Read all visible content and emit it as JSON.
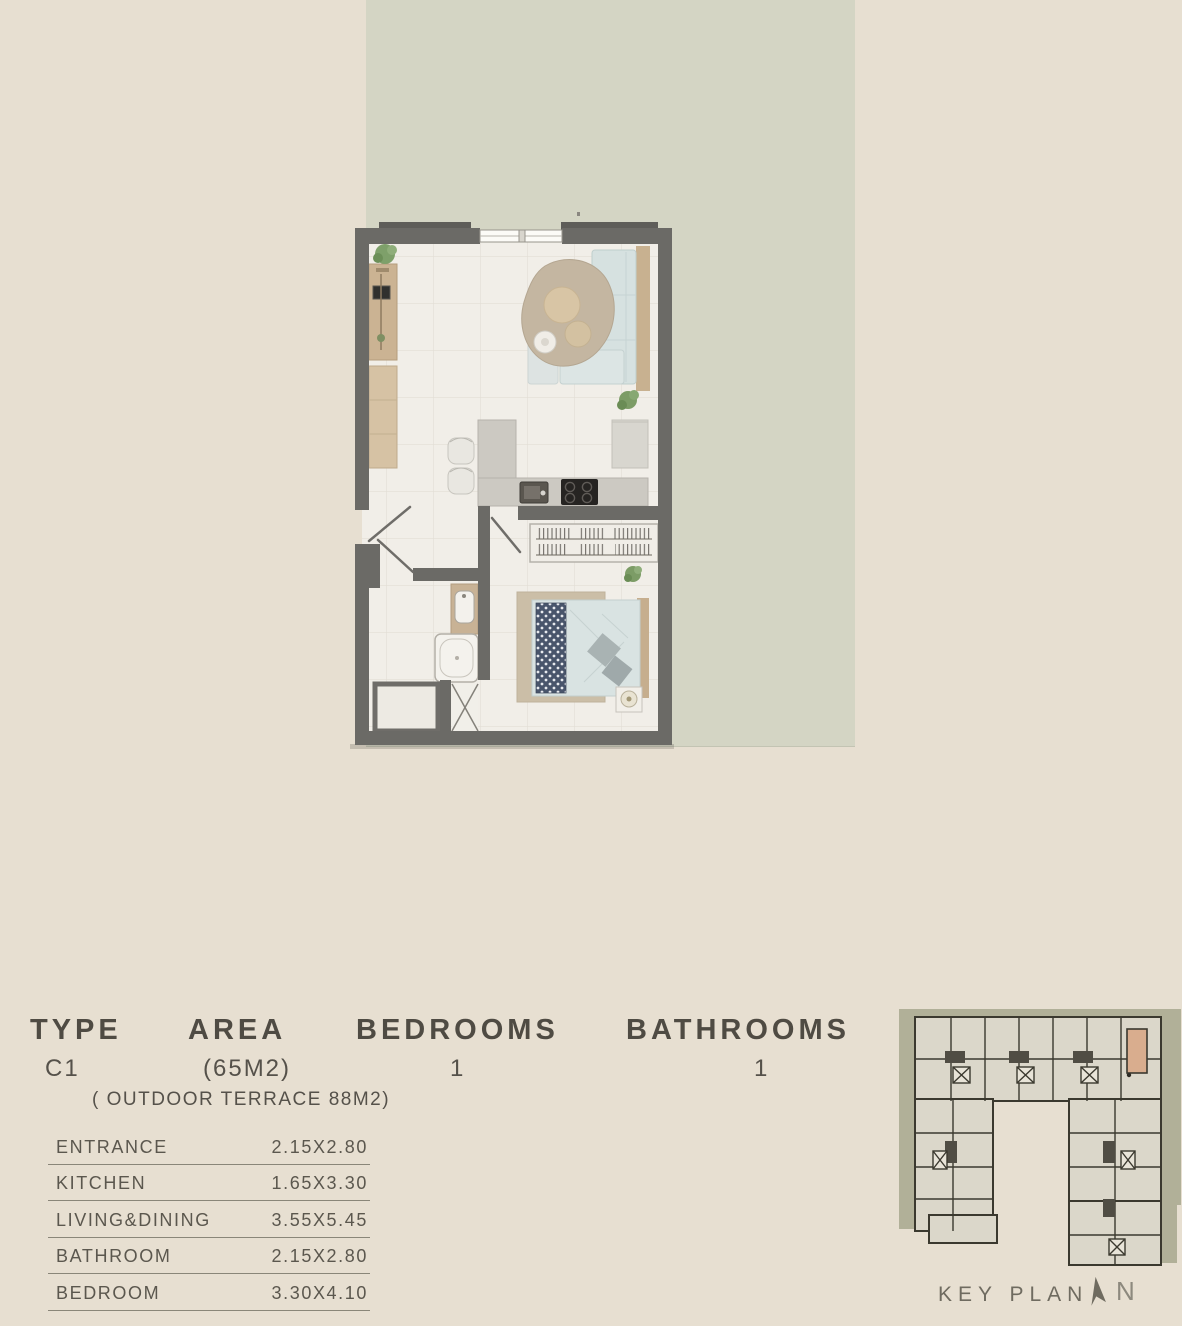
{
  "unit_table": {
    "headers": {
      "type": "TYPE",
      "area": "AREA",
      "bedrooms": "BEDROOMS",
      "bathrooms": "BATHROOMS"
    },
    "values": {
      "type": "C1",
      "area": "(65M2)",
      "bedrooms": "1",
      "bathrooms": "1"
    },
    "area_note": "( OUTDOOR TERRACE 88M2)"
  },
  "room_dimensions": [
    {
      "room": "ENTRANCE",
      "size": "2.15X2.80"
    },
    {
      "room": "KITCHEN",
      "size": "1.65X3.30"
    },
    {
      "room": "LIVING&DINING",
      "size": "3.55X5.45"
    },
    {
      "room": "BATHROOM",
      "size": "2.15X2.80"
    },
    {
      "room": "BEDROOM",
      "size": "3.30X4.10"
    }
  ],
  "key_plan": {
    "label": "KEY PLAN",
    "north_label": "N"
  },
  "colors": {
    "background": "#e7dfd1",
    "terrace": "#d4d5c4",
    "walls": "#6b6a66",
    "floor": "#f1eee8",
    "wood": "#c8b190",
    "upholstery_blue": "#d6e1e0",
    "highlight_unit": "#d9ad8e",
    "text": "#55514a"
  }
}
